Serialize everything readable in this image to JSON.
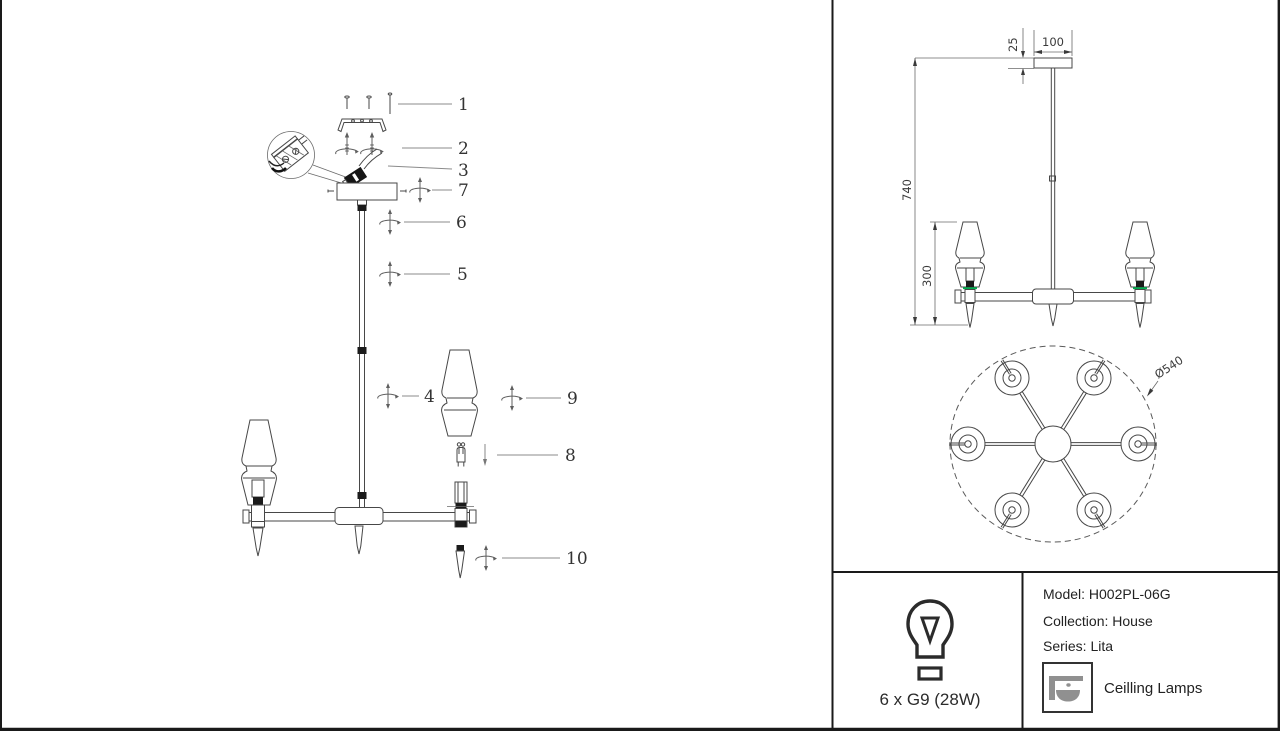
{
  "colors": {
    "line": "#474747",
    "leader": "#8b8b8b",
    "accent_green": "#00b050",
    "black_fill": "#1b1b1b",
    "icon_gray": "#909090",
    "border": "#1a1a1a"
  },
  "exploded_view": {
    "part_labels": {
      "p1": "1",
      "p2": "2",
      "p3": "3",
      "p7": "7",
      "p6": "6",
      "p5": "5",
      "p4": "4",
      "p9": "9",
      "p8": "8",
      "p10": "10"
    }
  },
  "side_view": {
    "dims": {
      "canopy_height": "25",
      "canopy_width": "100",
      "overall_height": "740",
      "shade_drop": "300"
    }
  },
  "top_view": {
    "dims": {
      "diameter": "Ø540"
    }
  },
  "spec_panel": {
    "bulb_spec": "6 x G9 (28W)",
    "model": "Model: H002PL-06G",
    "collection": "Collection: House",
    "series": "Series: Lita",
    "category": "Ceilling Lamps"
  }
}
